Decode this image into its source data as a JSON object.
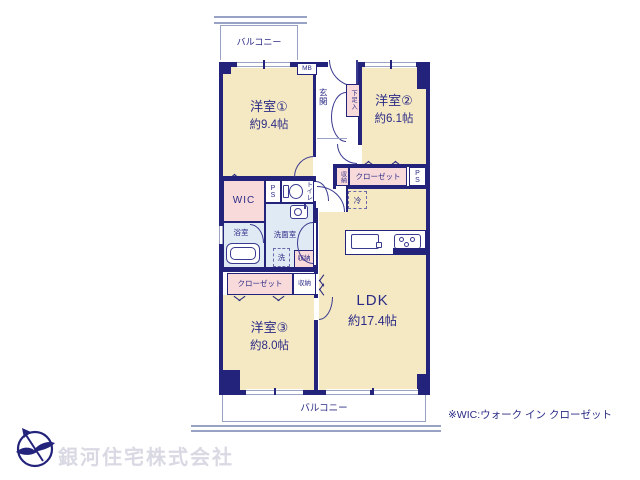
{
  "labels": {
    "balcony": "バルコニー",
    "mb": "MB",
    "entrance": "玄関",
    "shoe_cabinet": "下足入",
    "room1_name": "洋室①",
    "room1_size": "約9.4帖",
    "room2_name": "洋室②",
    "room2_size": "約6.1帖",
    "room3_name": "洋室③",
    "room3_size": "約8.0帖",
    "ldk_name": "LDK",
    "ldk_size": "約17.4帖",
    "wic": "WIC",
    "ps": "PS",
    "toilet": "トイレ",
    "bath": "浴室",
    "washroom": "洗面室",
    "washer": "洗",
    "fridge": "冷",
    "storage": "収納",
    "closet": "クローゼット",
    "note": "※WIC:ウォーク イン クローゼット",
    "company": "銀河住宅株式会社"
  },
  "colors": {
    "wall": "#23237b",
    "room_fill": "#f5e9c4",
    "closet_fill": "#f9dadb",
    "wet_area_fill": "#dfeaf5",
    "text": "#2b2b86",
    "balcony_line": "#98a2c4",
    "company_text": "#d9d9e4"
  }
}
